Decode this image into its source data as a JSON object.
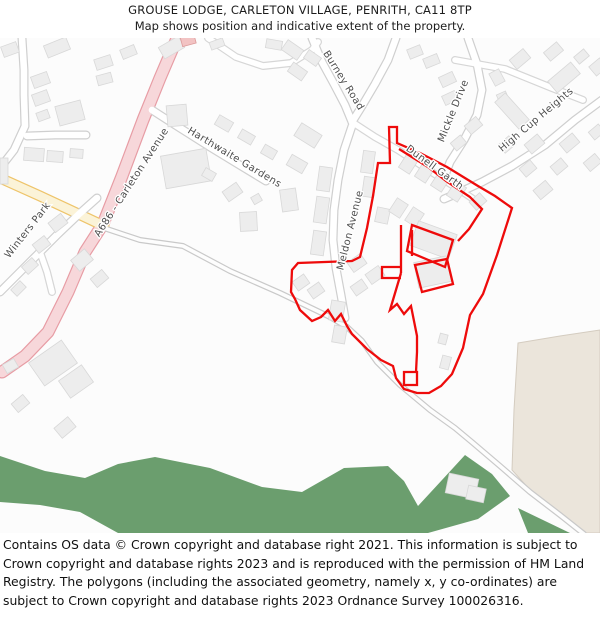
{
  "header": {
    "title": "GROUSE LODGE, CARLETON VILLAGE, PENRITH, CA11 8TP",
    "subtitle": "Map shows position and indicative extent of the property."
  },
  "footer": {
    "copyright": "Contains OS data © Crown copyright and database right 2021. This information is subject to Crown copyright and database rights 2023 and is reproduced with the permission of HM Land Registry. The polygons (including the associated geometry, namely x, y co-ordinates) are subject to Crown copyright and database rights 2023 Ordnance Survey 100026316."
  },
  "map": {
    "background": "#fcfcfc",
    "colors": {
      "building_fill": "#ededed",
      "building_stroke": "#d8d8d8",
      "pink_building_fill": "#f2c3c3",
      "pink_building_stroke": "#dc9a9a",
      "boundary_red": "#ee0b0b",
      "woodland_green": "#6b9e6e",
      "field_beige": "#ebe5db",
      "field_stroke": "#d4ccc0",
      "label_grey": "#4d4d4d"
    },
    "road_styles": {
      "pink": {
        "casing": "#e79ca4",
        "fill": "#f7d7da",
        "w": 13
      },
      "yellow": {
        "casing": "#eec46a",
        "fill": "#fbf3d8",
        "w": 11
      },
      "white": {
        "casing": "#cfcfcf",
        "fill": "#ffffff",
        "w": 9
      },
      "minor": {
        "casing": "#d6d6d6",
        "fill": "#ffffff",
        "w": 8
      },
      "track": {
        "casing": "#c9c9c9",
        "fill": "#fdfdfd",
        "w": 6
      }
    },
    "areas": [
      {
        "name": "field-area",
        "fill": "#ebe5db",
        "stroke": "#d4ccc0",
        "d": "M 518,343 L 560,336 L 600,330 L 600,533 L 586,533 L 540,501 L 512,470 L 514,410 Z"
      },
      {
        "name": "woodland-area",
        "fill": "#6b9e6e",
        "stroke": "none",
        "d": "M 0,456 L 45,471 L 85,478 L 118,464 L 155,457 L 210,468 L 262,487 L 302,492 L 344,468 L 388,466 L 404,481 L 418,506 L 442,480 L 465,455 L 492,474 L 510,496 L 478,519 L 428,533 L 118,533 L 80,512 L 40,505 L 0,502 Z"
      },
      {
        "name": "woodland-area",
        "fill": "#6b9e6e",
        "stroke": "none",
        "d": "M 518,508 L 570,533 L 528,533 Z"
      }
    ],
    "roads": [
      {
        "name": "a686-carleton-avenue",
        "type": "pink",
        "pts": "178,36 160,78 143,120 122,176 103,224 85,252 68,292 48,332 25,356 2,372"
      },
      {
        "name": "yellow-road",
        "type": "yellow",
        "pts": "0,178 40,196 70,210 104,226"
      },
      {
        "name": "farm-track",
        "type": "track",
        "pts": "104,228 140,240 183,246 230,271 280,293 330,317 347,327 362,341 377,362 400,385 430,410 455,428 473,443 500,466 530,492 560,515 584,534"
      },
      {
        "name": "meldon-avenue",
        "type": "white",
        "pts": "352,126 344,150 338,180 334,210 333,240 336,268 341,295 345,318"
      },
      {
        "name": "burney-road",
        "type": "white",
        "pts": "312,38 322,62 334,84 345,105 352,122"
      },
      {
        "name": "burney-road-upper",
        "type": "white",
        "pts": "352,122 362,106 375,84 388,60 396,38"
      },
      {
        "name": "dunell-garth-road",
        "type": "minor",
        "pts": "355,124 375,137 398,150 430,171 460,190 479,203"
      },
      {
        "name": "mickle-drive",
        "type": "white",
        "pts": "468,38 477,64 482,90 477,115 464,140 450,162 444,178"
      },
      {
        "name": "high-cup-heights-road",
        "type": "white",
        "pts": "602,100 575,120 545,145 512,166 482,182 458,193 444,199"
      },
      {
        "name": "high-cup-branch",
        "type": "minor",
        "pts": "455,60 505,69 552,88 583,100"
      },
      {
        "name": "top-middle-road",
        "type": "minor",
        "pts": "208,38 236,57 263,66 291,63 312,50 318,42"
      },
      {
        "name": "harthwaite-gardens-road",
        "type": "white",
        "pts": "152,110 180,128 210,147 238,164 266,181"
      },
      {
        "name": "top-left-road",
        "type": "white",
        "pts": "22,38 24,70 24,95 25,126 14,150 0,168"
      },
      {
        "name": "top-left-culdesac",
        "type": "white",
        "pts": "27,136 55,135 86,135"
      },
      {
        "name": "winters-park-road",
        "type": "white",
        "pts": "97,198 78,215 58,234 38,254 22,270 8,284 0,292"
      },
      {
        "name": "winters-park-stub",
        "type": "minor",
        "pts": "40,252 47,272 52,292"
      }
    ],
    "buildings": [
      [
        2,
        44,
        16,
        11,
        -20
      ],
      [
        45,
        41,
        24,
        13,
        -22
      ],
      [
        95,
        57,
        17,
        11,
        -18
      ],
      [
        121,
        47,
        15,
        10,
        -22
      ],
      [
        160,
        41,
        23,
        13,
        -30
      ],
      [
        97,
        74,
        15,
        10,
        -15
      ],
      [
        32,
        74,
        17,
        12,
        -20
      ],
      [
        33,
        92,
        16,
        12,
        -20
      ],
      [
        57,
        103,
        26,
        20,
        -15
      ],
      [
        37,
        111,
        12,
        9,
        -20
      ],
      [
        24,
        148,
        20,
        13,
        4
      ],
      [
        47,
        151,
        16,
        11,
        4
      ],
      [
        70,
        149,
        13,
        9,
        4
      ],
      [
        0,
        158,
        8,
        26,
        0
      ],
      [
        167,
        105,
        20,
        21,
        -5
      ],
      [
        163,
        152,
        46,
        33,
        -10
      ],
      [
        210,
        40,
        14,
        8,
        -20
      ],
      [
        266,
        40,
        16,
        9,
        10
      ],
      [
        181,
        34,
        14,
        11,
        -15,
        "p"
      ],
      [
        283,
        44,
        19,
        12,
        35
      ],
      [
        289,
        66,
        17,
        11,
        35
      ],
      [
        305,
        53,
        15,
        10,
        35
      ],
      [
        362,
        151,
        12,
        22,
        8
      ],
      [
        363,
        177,
        12,
        20,
        8
      ],
      [
        376,
        208,
        13,
        15,
        12
      ],
      [
        424,
        56,
        15,
        10,
        -22
      ],
      [
        408,
        47,
        14,
        10,
        -22
      ],
      [
        440,
        74,
        15,
        11,
        -25
      ],
      [
        443,
        93,
        14,
        10,
        -25
      ],
      [
        490,
        72,
        14,
        11,
        62
      ],
      [
        497,
        94,
        13,
        10,
        66
      ],
      [
        511,
        53,
        18,
        12,
        -40
      ],
      [
        545,
        46,
        17,
        11,
        -40
      ],
      [
        575,
        52,
        13,
        9,
        -40
      ],
      [
        549,
        70,
        30,
        15,
        -40
      ],
      [
        592,
        60,
        12,
        14,
        50
      ],
      [
        505,
        93,
        14,
        36,
        -42
      ],
      [
        466,
        120,
        15,
        11,
        -40
      ],
      [
        452,
        138,
        13,
        10,
        -40
      ],
      [
        500,
        139,
        14,
        11,
        -40
      ],
      [
        526,
        138,
        17,
        12,
        -40
      ],
      [
        561,
        137,
        17,
        12,
        -40
      ],
      [
        590,
        127,
        13,
        10,
        -40
      ],
      [
        521,
        163,
        14,
        11,
        -40
      ],
      [
        552,
        161,
        14,
        11,
        -40
      ],
      [
        585,
        157,
        15,
        11,
        -40
      ],
      [
        535,
        184,
        16,
        12,
        -40
      ],
      [
        471,
        196,
        14,
        11,
        -42
      ],
      [
        216,
        118,
        16,
        11,
        30
      ],
      [
        239,
        132,
        15,
        10,
        30
      ],
      [
        262,
        147,
        14,
        10,
        30
      ],
      [
        296,
        128,
        24,
        15,
        32
      ],
      [
        288,
        158,
        18,
        12,
        30
      ],
      [
        203,
        170,
        12,
        9,
        30
      ],
      [
        224,
        186,
        17,
        12,
        -35
      ],
      [
        240,
        212,
        17,
        19,
        -3
      ],
      [
        281,
        189,
        16,
        22,
        -8
      ],
      [
        252,
        195,
        9,
        8,
        -30
      ],
      [
        318,
        167,
        13,
        24,
        8
      ],
      [
        315,
        197,
        13,
        26,
        8
      ],
      [
        312,
        231,
        13,
        24,
        8
      ],
      [
        50,
        217,
        16,
        12,
        -38
      ],
      [
        34,
        239,
        15,
        11,
        -38
      ],
      [
        73,
        253,
        18,
        14,
        -40
      ],
      [
        92,
        273,
        15,
        11,
        -40
      ],
      [
        23,
        261,
        14,
        10,
        -42
      ],
      [
        12,
        284,
        13,
        9,
        -45
      ],
      [
        33,
        349,
        40,
        28,
        -35
      ],
      [
        62,
        371,
        28,
        21,
        -35
      ],
      [
        4,
        361,
        13,
        10,
        -30
      ],
      [
        13,
        398,
        15,
        11,
        -40
      ],
      [
        56,
        421,
        18,
        13,
        -40
      ],
      [
        402,
        155,
        13,
        17,
        33
      ],
      [
        418,
        164,
        13,
        17,
        33
      ],
      [
        434,
        173,
        13,
        17,
        33
      ],
      [
        450,
        183,
        13,
        17,
        33
      ],
      [
        392,
        200,
        13,
        16,
        33
      ],
      [
        408,
        209,
        13,
        16,
        33
      ],
      [
        413,
        227,
        41,
        26,
        20
      ],
      [
        416,
        259,
        33,
        26,
        -12
      ],
      [
        349,
        257,
        16,
        12,
        -35
      ],
      [
        367,
        269,
        16,
        12,
        -35
      ],
      [
        352,
        282,
        14,
        11,
        -35
      ],
      [
        330,
        301,
        14,
        20,
        10
      ],
      [
        333,
        326,
        13,
        17,
        10
      ],
      [
        294,
        277,
        14,
        11,
        -35
      ],
      [
        309,
        285,
        14,
        11,
        -35
      ],
      [
        439,
        334,
        8,
        10,
        15
      ],
      [
        441,
        356,
        9,
        13,
        15
      ],
      [
        447,
        476,
        30,
        20,
        12
      ],
      [
        467,
        487,
        18,
        14,
        12
      ]
    ],
    "boundary": {
      "color": "#ee0b0b",
      "stroke_width": 2.3,
      "paths": [
        "M 389,127 L 397,127 L 397,143 L 420,153 L 447,167 L 478,186 L 495,196 L 512,208 L 497,255 L 483,294 L 470,315 L 463,348 L 452,374 L 441,386 L 429,393 L 417,393 L 404,389 L 396,378 L 393,366 L 381,360 L 367,349 L 352,334 L 347,326 L 341,314 L 335,321 L 328,310 L 321,317 L 312,321 L 300,310 L 295,299 L 291,292 L 292,270 L 298,263 L 352,261 L 360,257 L 367,228 L 373,196 L 378,163 L 390,163 Z",
        "M 399,149 L 428,167 L 446,181 L 470,197 L 482,209 L 469,229 L 458,241",
        "M 412,225 L 453,240 L 445,267 L 407,251 Z",
        "M 415,265 L 447,259 L 453,284 L 422,292 Z",
        "M 401,273 L 390,310 L 397,304 L 404,314 L 411,306 L 417,336 L 417,352 L 416,372",
        "M 401,225 L 401,273",
        "M 412,230 L 412,256",
        "M 401,267 L 382,267 L 382,278 L 401,278",
        "M 404,372 L 417,372 L 417,385 L 404,385 Z"
      ]
    },
    "labels": [
      {
        "name": "street-label-burney-road",
        "text": "Burney Road",
        "x": 341,
        "y": 82,
        "rot": 58
      },
      {
        "name": "street-label-mickle-drive",
        "text": "Mickle Drive",
        "x": 456,
        "y": 112,
        "rot": -68
      },
      {
        "name": "street-label-high-cup-heights",
        "text": "High Cup Heights",
        "x": 538,
        "y": 122,
        "rot": -40
      },
      {
        "name": "street-label-harthwaite-gardens",
        "text": "Harthwaite Gardens",
        "x": 233,
        "y": 160,
        "rot": 31
      },
      {
        "name": "street-label-a686",
        "text": "A686 - Carleton Avenue",
        "x": 134,
        "y": 184,
        "rot": -57
      },
      {
        "name": "street-label-winters-park",
        "text": "Winters Park",
        "x": 30,
        "y": 232,
        "rot": -52
      },
      {
        "name": "street-label-meldon-avenue",
        "text": "Meldon Avenue",
        "x": 353,
        "y": 231,
        "rot": -76
      },
      {
        "name": "street-label-dunell-garth",
        "text": "Dunell Garth",
        "x": 433,
        "y": 170,
        "rot": 36
      }
    ]
  }
}
